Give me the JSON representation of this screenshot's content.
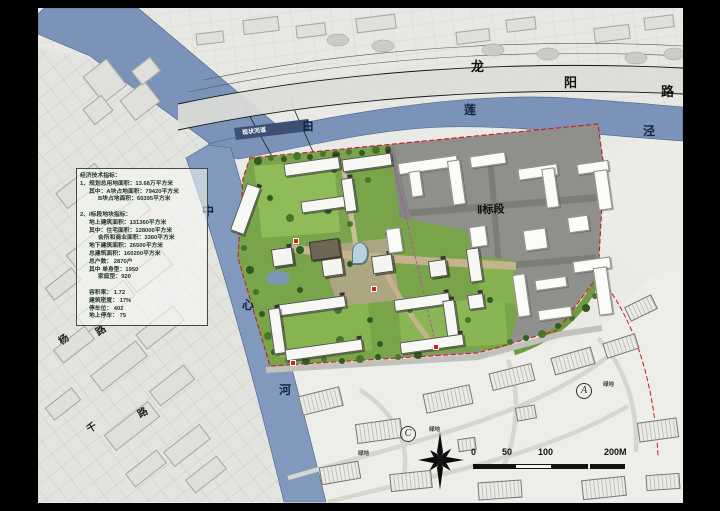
{
  "title": "residential district master plan sheet",
  "colors": {
    "frame": "#000000",
    "paper": "#e9e9e6",
    "river": "#7b93b8",
    "site_green": "#79a449",
    "site_gray": "#8f8f8c",
    "boundary_red": "#d41616",
    "divider_magenta": "#bb44bb"
  },
  "panel": {
    "name": "economic-technical-indicators",
    "lines": [
      {
        "text": "经济技术指标：",
        "indent": 0
      },
      {
        "text": "1、规划总用地面积：13.68万平方米",
        "indent": 0
      },
      {
        "text": "其中：A块占地面积：79420平方米",
        "indent": 1
      },
      {
        "text": "B块占地面积：60395平方米",
        "indent": 2
      },
      {
        "text": "",
        "indent": 0
      },
      {
        "text": "2、I标段地块指标：",
        "indent": 0
      },
      {
        "text": "地上建筑面积：131360平方米",
        "indent": 1
      },
      {
        "text": "其中：住宅面积：128000平方米",
        "indent": 1
      },
      {
        "text": "会所和商业面积：3360平方米",
        "indent": 2
      },
      {
        "text": "地下建筑面积：26500平方米",
        "indent": 1
      },
      {
        "text": "总建筑面积：160200平方米",
        "indent": 1
      },
      {
        "text": "总户数：  2870户",
        "indent": 1
      },
      {
        "text": "其中  单身型：1950",
        "indent": 1
      },
      {
        "text": "家庭型：920",
        "indent": 2
      },
      {
        "text": "",
        "indent": 0
      },
      {
        "text": "容积率：    1.72",
        "indent": 1
      },
      {
        "text": "建筑密度：  17%",
        "indent": 1
      },
      {
        "text": "停车位：    402",
        "indent": 1
      },
      {
        "text": "地上停车：  75",
        "indent": 1
      }
    ]
  },
  "map_labels": [
    {
      "name": "road-longyang-char-long",
      "text": "龙",
      "x": 433,
      "y": 48,
      "size": 13,
      "color": "#111111",
      "rot": 0,
      "circled": false
    },
    {
      "name": "road-longyang-char-yang",
      "text": "阳",
      "x": 526,
      "y": 64,
      "size": 13,
      "color": "#111111",
      "rot": 0,
      "circled": false
    },
    {
      "name": "road-longyang-char-lu",
      "text": "路",
      "x": 623,
      "y": 73,
      "size": 13,
      "color": "#111111",
      "rot": 0,
      "circled": false
    },
    {
      "name": "river-bailianjing-char-bai",
      "text": "白",
      "x": 264,
      "y": 109,
      "size": 12,
      "color": "#10233f",
      "rot": 0,
      "circled": false
    },
    {
      "name": "river-bailianjing-char-lian",
      "text": "莲",
      "x": 426,
      "y": 93,
      "size": 12,
      "color": "#10233f",
      "rot": 0,
      "circled": false
    },
    {
      "name": "river-bailianjing-char-jing",
      "text": "泾",
      "x": 605,
      "y": 114,
      "size": 12,
      "color": "#10233f",
      "rot": 0,
      "circled": false
    },
    {
      "name": "river-zhongxinhe-char-zhong",
      "text": "中",
      "x": 164,
      "y": 194,
      "size": 12,
      "color": "#10233f",
      "rot": 0,
      "circled": false
    },
    {
      "name": "river-zhongxinhe-char-xin",
      "text": "心",
      "x": 204,
      "y": 288,
      "size": 12,
      "color": "#10233f",
      "rot": 0,
      "circled": false
    },
    {
      "name": "river-zhongxinhe-char-he",
      "text": "河",
      "x": 241,
      "y": 373,
      "size": 12,
      "color": "#10233f",
      "rot": 0,
      "circled": false
    },
    {
      "name": "section-2-label",
      "text": "Ⅱ标段",
      "x": 439,
      "y": 193,
      "size": 11,
      "color": "#111111",
      "rot": -2,
      "circled": false
    },
    {
      "name": "existing-channel-label",
      "text": "现状河道",
      "x": 204,
      "y": 118,
      "size": 6,
      "color": "#ffffff",
      "rot": -7,
      "circled": false
    },
    {
      "name": "oldmap-road-char-yang",
      "text": "杨",
      "x": 20,
      "y": 323,
      "size": 10,
      "color": "#222222",
      "rot": -35,
      "circled": false
    },
    {
      "name": "oldmap-road-char-lu-1",
      "text": "路",
      "x": 57,
      "y": 314,
      "size": 10,
      "color": "#222222",
      "rot": -35,
      "circled": false
    },
    {
      "name": "oldmap-road-char-qian",
      "text": "千",
      "x": 48,
      "y": 411,
      "size": 10,
      "color": "#222222",
      "rot": -30,
      "circled": false
    },
    {
      "name": "oldmap-road-char-lu-2",
      "text": "路",
      "x": 99,
      "y": 396,
      "size": 10,
      "color": "#222222",
      "rot": -30,
      "circled": false
    },
    {
      "name": "green-space-label-1",
      "text": "绿地",
      "x": 565,
      "y": 372,
      "size": 5.5,
      "color": "#444444",
      "rot": 0,
      "circled": false
    },
    {
      "name": "green-space-label-2",
      "text": "绿地",
      "x": 391,
      "y": 417,
      "size": 5.5,
      "color": "#444444",
      "rot": 0,
      "circled": false
    },
    {
      "name": "green-space-label-3",
      "text": "绿地",
      "x": 320,
      "y": 441,
      "size": 5.5,
      "color": "#444444",
      "rot": 0,
      "circled": false
    },
    {
      "name": "zone-letter-a",
      "text": "A",
      "x": 538,
      "y": 375,
      "size": 10,
      "color": "#222222",
      "rot": 0,
      "circled": true
    },
    {
      "name": "zone-letter-c",
      "text": "C",
      "x": 362,
      "y": 418,
      "size": 10,
      "color": "#222222",
      "rot": 0,
      "circled": true
    }
  ],
  "scale_bar": {
    "y_bar": 456,
    "h": 5,
    "segments": [
      {
        "x": 435,
        "w": 42,
        "filled": true
      },
      {
        "x": 477,
        "w": 37,
        "filled": false
      },
      {
        "x": 514,
        "w": 36,
        "filled": true
      },
      {
        "x": 552,
        "w": 35,
        "filled": true
      }
    ],
    "labels": [
      {
        "text": "0",
        "x": 433,
        "y": 439
      },
      {
        "text": "50",
        "x": 464,
        "y": 439
      },
      {
        "text": "100",
        "x": 500,
        "y": 439
      },
      {
        "text": "200M",
        "x": 566,
        "y": 439
      }
    ]
  },
  "entrances": [
    [
      255,
      230
    ],
    [
      333,
      278
    ],
    [
      252,
      352
    ],
    [
      395,
      336
    ]
  ],
  "trees": {
    "fills": [
      "#2f5a24",
      "#47742f"
    ],
    "points": [
      [
        220,
        153
      ],
      [
        233,
        150
      ],
      [
        246,
        151
      ],
      [
        259,
        148
      ],
      [
        272,
        149
      ],
      [
        285,
        146
      ],
      [
        298,
        147
      ],
      [
        311,
        144
      ],
      [
        324,
        145
      ],
      [
        338,
        142
      ],
      [
        350,
        141
      ],
      [
        206,
        240
      ],
      [
        212,
        262
      ],
      [
        218,
        284
      ],
      [
        224,
        306
      ],
      [
        230,
        328
      ],
      [
        236,
        344
      ],
      [
        250,
        352
      ],
      [
        268,
        353
      ],
      [
        286,
        351
      ],
      [
        304,
        353
      ],
      [
        322,
        351
      ],
      [
        340,
        349
      ],
      [
        360,
        349
      ],
      [
        380,
        347
      ],
      [
        472,
        334
      ],
      [
        488,
        330
      ],
      [
        504,
        326
      ],
      [
        520,
        318
      ],
      [
        534,
        310
      ],
      [
        548,
        300
      ],
      [
        557,
        288
      ],
      [
        232,
        190
      ],
      [
        252,
        210
      ],
      [
        296,
        162
      ],
      [
        330,
        172
      ],
      [
        290,
        202
      ],
      [
        312,
        216
      ],
      [
        262,
        282
      ],
      [
        300,
        302
      ],
      [
        332,
        312
      ],
      [
        372,
        302
      ],
      [
        412,
        302
      ],
      [
        430,
        312
      ],
      [
        452,
        292
      ],
      [
        302,
        332
      ],
      [
        342,
        336
      ],
      [
        420,
        332
      ],
      [
        262,
        242
      ],
      [
        350,
        226
      ],
      [
        312,
        256
      ],
      [
        242,
        320
      ]
    ]
  },
  "site_plan": {
    "section1": [
      [
        200,
        176,
        15,
        50,
        20,
        "s1"
      ],
      [
        246,
        152,
        56,
        13,
        -8,
        "s1"
      ],
      [
        304,
        148,
        50,
        13,
        -8,
        "s1"
      ],
      [
        263,
        190,
        52,
        12,
        -8,
        "s1"
      ],
      [
        305,
        170,
        12,
        34,
        -8,
        "s1"
      ],
      [
        238,
        292,
        70,
        12,
        -8,
        "s1"
      ],
      [
        233,
        300,
        12,
        46,
        -8,
        "s1"
      ],
      [
        247,
        336,
        78,
        12,
        -8,
        "s1"
      ],
      [
        356,
        288,
        56,
        12,
        -8,
        "s1"
      ],
      [
        407,
        292,
        12,
        40,
        -8,
        "s1"
      ],
      [
        362,
        330,
        64,
        12,
        -8,
        "s1"
      ],
      [
        430,
        240,
        13,
        34,
        -8,
        "s1"
      ],
      [
        430,
        286,
        16,
        15,
        -8,
        "s1"
      ],
      [
        234,
        240,
        21,
        18,
        -8,
        "t1"
      ],
      [
        284,
        250,
        21,
        18,
        -8,
        "t1"
      ],
      [
        334,
        247,
        21,
        18,
        -8,
        "t1"
      ],
      [
        391,
        252,
        18,
        17,
        -8,
        "t1"
      ],
      [
        272,
        232,
        30,
        19,
        -8,
        "dark"
      ],
      [
        314,
        234,
        16,
        22,
        0,
        "glass"
      ]
    ],
    "section2": [
      [
        360,
        151,
        60,
        12,
        -8
      ],
      [
        372,
        163,
        12,
        26,
        -8
      ],
      [
        412,
        152,
        13,
        45,
        -8
      ],
      [
        432,
        146,
        36,
        12,
        -8
      ],
      [
        480,
        158,
        40,
        12,
        -8
      ],
      [
        506,
        160,
        13,
        40,
        -8
      ],
      [
        539,
        154,
        32,
        11,
        -8
      ],
      [
        558,
        162,
        14,
        40,
        -8
      ],
      [
        432,
        218,
        17,
        21,
        -8
      ],
      [
        486,
        221,
        23,
        21,
        -8
      ],
      [
        530,
        208,
        21,
        16,
        -8
      ],
      [
        349,
        220,
        15,
        25,
        -8
      ],
      [
        477,
        266,
        13,
        43,
        -8
      ],
      [
        497,
        270,
        32,
        11,
        -8
      ],
      [
        535,
        251,
        38,
        12,
        -8
      ],
      [
        558,
        259,
        14,
        48,
        -8
      ],
      [
        500,
        300,
        34,
        11,
        -8
      ]
    ],
    "villas": [
      [
        262,
        383,
        42,
        20,
        -14
      ],
      [
        318,
        413,
        46,
        20,
        -8
      ],
      [
        386,
        381,
        48,
        20,
        -12
      ],
      [
        452,
        360,
        44,
        18,
        -14
      ],
      [
        514,
        344,
        42,
        18,
        -16
      ],
      [
        566,
        330,
        34,
        16,
        -18
      ],
      [
        600,
        412,
        40,
        20,
        -8
      ],
      [
        282,
        456,
        40,
        18,
        -10
      ],
      [
        352,
        464,
        42,
        18,
        -6
      ],
      [
        440,
        473,
        44,
        18,
        -4
      ],
      [
        544,
        470,
        44,
        20,
        -6
      ],
      [
        608,
        466,
        34,
        16,
        -4
      ],
      [
        478,
        398,
        20,
        14,
        -10
      ],
      [
        420,
        430,
        18,
        13,
        -8
      ],
      [
        588,
        292,
        30,
        16,
        -26
      ]
    ],
    "peninsula_blocks": [
      [
        52,
        56,
        30,
        34,
        -38
      ],
      [
        86,
        80,
        32,
        26,
        -38
      ],
      [
        48,
        92,
        24,
        20,
        -38
      ],
      [
        96,
        54,
        24,
        18,
        -38
      ]
    ],
    "top_blocks": [
      [
        205,
        10,
        36,
        15,
        -7
      ],
      [
        258,
        16,
        30,
        13,
        -7
      ],
      [
        318,
        8,
        40,
        15,
        -7
      ],
      [
        418,
        22,
        34,
        13,
        -7
      ],
      [
        468,
        10,
        30,
        13,
        -7
      ],
      [
        556,
        18,
        36,
        15,
        -7
      ],
      [
        606,
        8,
        30,
        13,
        -7
      ],
      [
        158,
        24,
        28,
        12,
        -7
      ]
    ],
    "old_map_blocks": [
      [
        18,
        168,
        50,
        20,
        -38
      ],
      [
        68,
        198,
        44,
        19,
        -38
      ],
      [
        28,
        228,
        56,
        20,
        -38
      ],
      [
        88,
        254,
        46,
        19,
        -38
      ],
      [
        38,
        288,
        60,
        20,
        -38
      ],
      [
        98,
        310,
        48,
        19,
        -38
      ],
      [
        52,
        348,
        58,
        20,
        -38
      ],
      [
        112,
        368,
        44,
        19,
        -38
      ],
      [
        66,
        408,
        56,
        20,
        -38
      ],
      [
        126,
        428,
        46,
        19,
        -38
      ],
      [
        16,
        328,
        40,
        17,
        -38
      ],
      [
        148,
        458,
        40,
        17,
        -38
      ],
      [
        88,
        452,
        40,
        17,
        -38
      ],
      [
        8,
        268,
        34,
        16,
        -38
      ],
      [
        8,
        388,
        34,
        16,
        -38
      ]
    ]
  }
}
